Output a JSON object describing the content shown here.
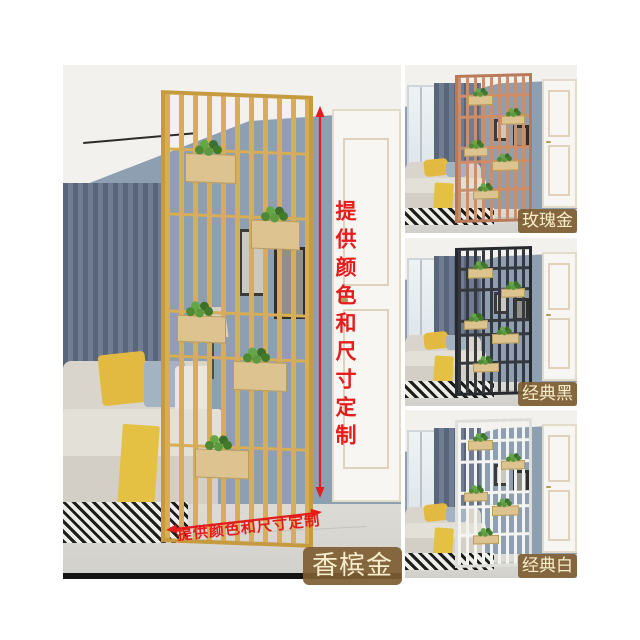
{
  "collage": {
    "main": {
      "badge": "香槟金",
      "divider": {
        "bar": "#d7ad55",
        "frame": "#c69a3e"
      }
    },
    "variants": [
      {
        "badge": "玫瑰金",
        "divider": {
          "bar": "#c98e6e",
          "frame": "#ba7a58"
        }
      },
      {
        "badge": "经典黑",
        "divider": {
          "bar": "#35393e",
          "frame": "#26292d"
        }
      },
      {
        "badge": "经典白",
        "divider": {
          "bar": "#f3f3ef",
          "frame": "#dededa"
        }
      }
    ],
    "annotations": {
      "vertical_note": "提供颜色和尺寸定制",
      "horizontal_note": "提供颜色和尺寸定制",
      "accent_color": "#e61b1b"
    },
    "badge_style": {
      "bg": "rgba(125,93,50,0.92)",
      "text": "#f9eecb"
    }
  }
}
